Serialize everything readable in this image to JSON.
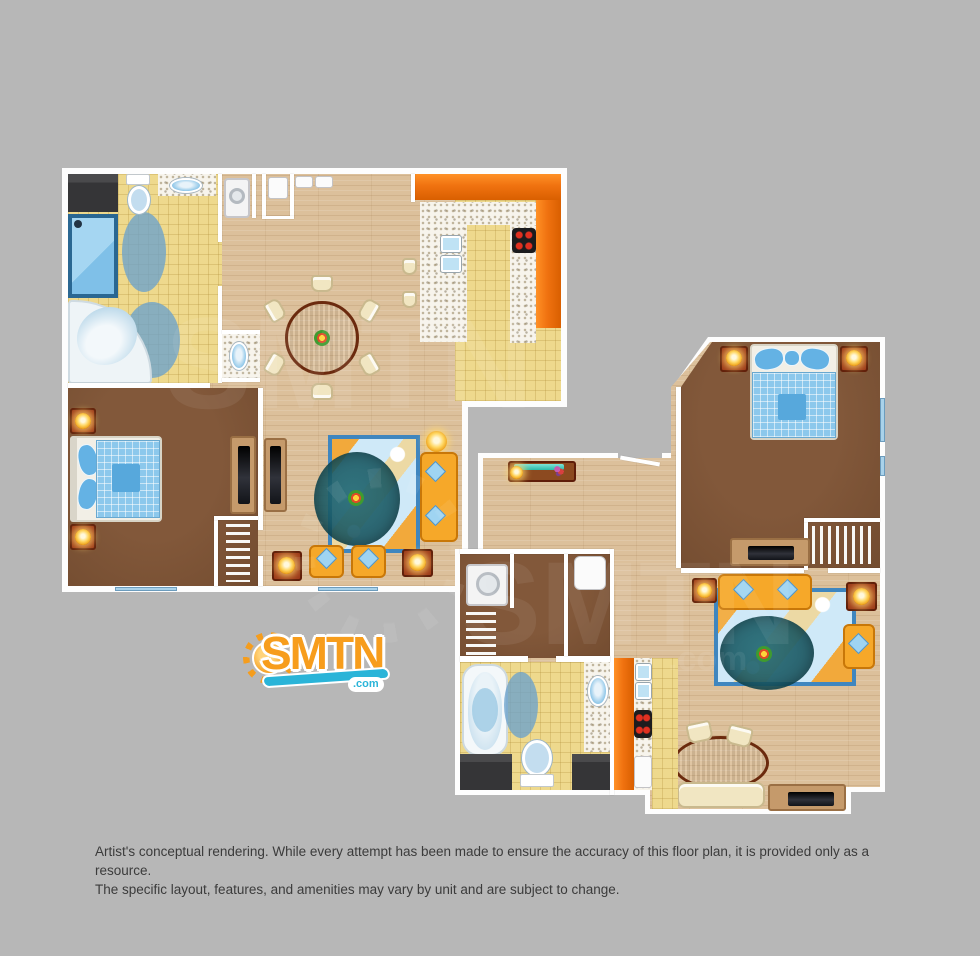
{
  "page": {
    "background": "#b7b7b7"
  },
  "logo": {
    "brand": "SMTN",
    "tld": ".com",
    "orange": "#f79d1c",
    "blue": "#2ab4d8"
  },
  "watermark": {
    "text": "SMTN",
    "tld": ".com"
  },
  "disclaimer": {
    "line1": "Artist's conceptual rendering. While every attempt has been made to ensure the accuracy of this floor plan, it is provided only as a resource.",
    "line2": "The specific layout, features, and amenities may vary by unit and are subject to change."
  },
  "palette": {
    "wall": "#ffffff",
    "wood_floor": "#dcc09b",
    "tile_floor": "#eed98d",
    "carpet": "#7b5134",
    "cabinet_orange": "#f07210",
    "counter_speckle": "#f7f4ec",
    "water_blue": "#8ec6e8",
    "rug_blue": "#cfe9f8",
    "sofa_orange": "#f6a829",
    "accent_wood": "#9c3a1a"
  }
}
